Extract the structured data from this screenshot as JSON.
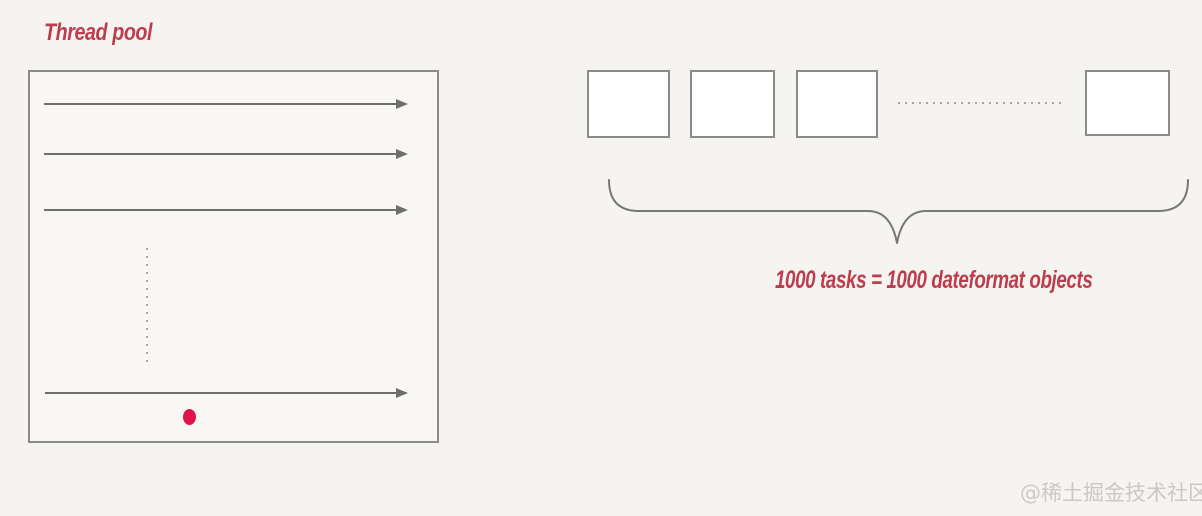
{
  "canvas": {
    "width": 1202,
    "height": 516,
    "background": "#f6f4f1"
  },
  "colors": {
    "accent_red": "#bc3e4e",
    "dot_red": "#e0134a",
    "line_gray": "#6e6e6e",
    "border_gray": "#8b8b8b",
    "dotted_gray": "#a6a6a6",
    "brace_gray": "#787878",
    "watermark_gray": "#cbc9c7"
  },
  "thread_pool": {
    "title": "Thread pool",
    "visible_thread_arrows": 4,
    "has_vertical_ellipsis": true,
    "has_red_dot": true
  },
  "tasks": {
    "visible_boxes": 4,
    "has_horizontal_ellipsis": true,
    "caption": "1000 tasks = 1000 dateformat objects"
  },
  "watermark": "@稀土掘金技术社区"
}
